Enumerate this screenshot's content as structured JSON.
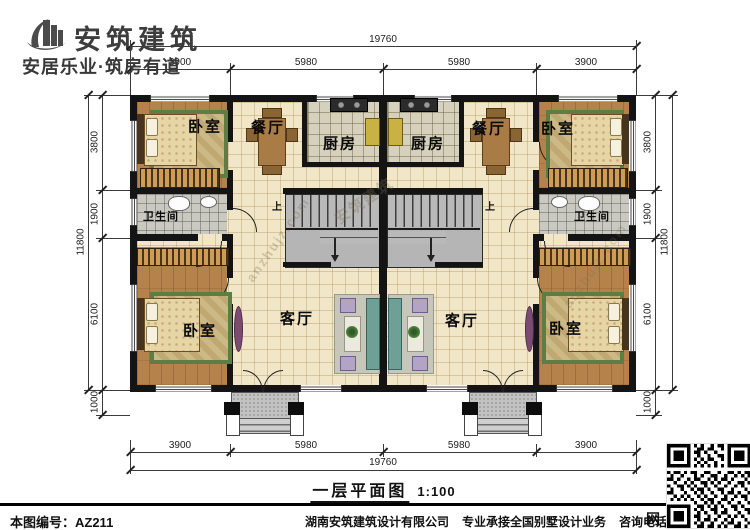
{
  "brand": {
    "name": "安筑建筑",
    "tagline": "安居乐业·筑房有道"
  },
  "plan": {
    "title": "一层平面图",
    "scale": "1:100"
  },
  "rooms": {
    "bedroom": "卧室",
    "dining": "餐厅",
    "kitchen": "厨房",
    "bathroom": "卫生间",
    "living": "客厅",
    "stairs_up": "上"
  },
  "dimensions": {
    "total_width": "19760",
    "total_height": "11800",
    "top_segments": [
      "3900",
      "5980",
      "5980",
      "3900"
    ],
    "bottom_segments": [
      "3900",
      "5980",
      "5980",
      "3900"
    ],
    "side_segments": [
      "3800",
      "1900",
      "6100",
      "1000"
    ]
  },
  "watermark": {
    "site": "anzhujz.com",
    "brand": "安筑建筑"
  },
  "footer": {
    "drawing_no": "本图编号：AZ211",
    "company": "湖南安筑建筑设计有限公司",
    "service": "专业承接全国别墅设计业务",
    "phone": "咨询电话：400-8070-511",
    "web": "网"
  },
  "colors": {
    "wall": "#141414",
    "floor": "#f1e7c8",
    "wood": "#b5824c",
    "accent_green": "#5e7d44"
  }
}
